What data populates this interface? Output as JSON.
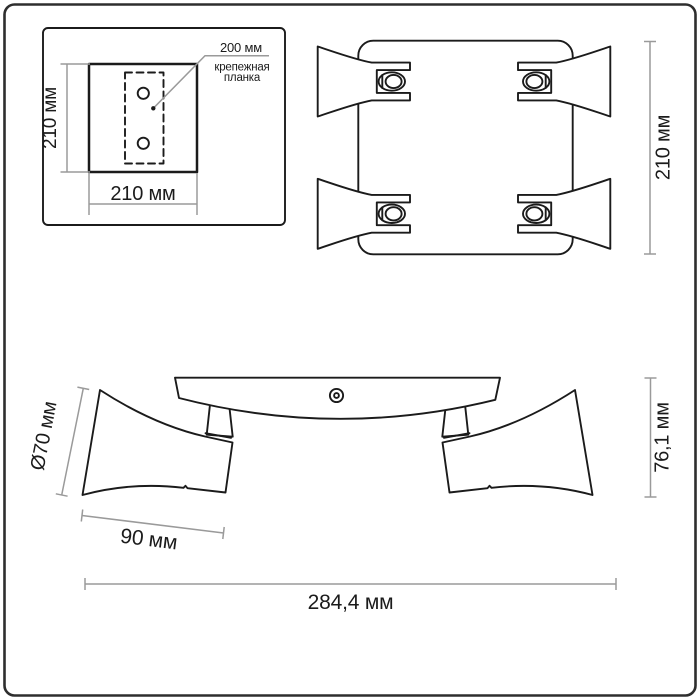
{
  "title": "Light fixture dimension drawing",
  "colors": {
    "line": "#1b1b1b",
    "dimension": "#9a9a9a",
    "border": "#2e2e2e",
    "background": "#ffffff"
  },
  "inset": {
    "height_label": "210 мм",
    "width_label": "210 мм",
    "hole_spacing_label": "200 мм",
    "mount_bar_label_line1": "крепежная",
    "mount_bar_label_line2": "планка"
  },
  "top_view": {
    "height_label": "210 мм"
  },
  "side_view": {
    "diameter_label": "Ø70 мм",
    "horn_length_label": "90 мм",
    "height_label": "76,1 мм",
    "overall_width_label": "284,4 мм"
  }
}
